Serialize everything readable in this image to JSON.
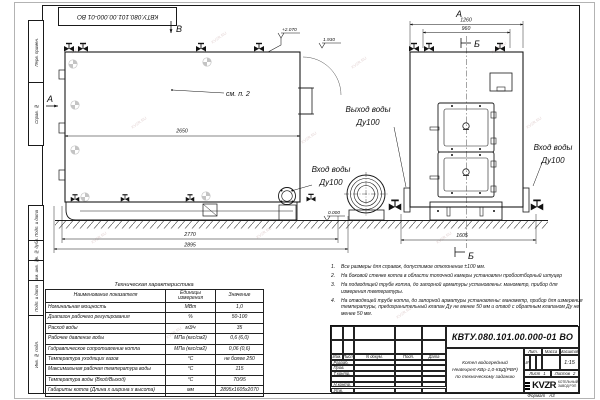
{
  "watermark": "KVZR.RU",
  "top_stamp": "КВТУ.080.101.00.000-01  ВО",
  "margin_labels": [
    "Перв. примен.",
    "Справ. №",
    "Подп. и дата",
    "Инв. № дубл.",
    "Взам. инв. №",
    "Подп. и дата",
    "Инв. № подл."
  ],
  "views": {
    "side": {
      "view_arrow_top": "В",
      "view_arrow_left": "А",
      "callout": "см. п. 2",
      "dim_length": "2650",
      "dim_base": "2770",
      "dim_overall": "2895",
      "elev_top": "+2.070",
      "elev_mid": "1.930",
      "elev_zero": "0.000"
    },
    "front": {
      "view_label": "А",
      "section_label": "Б",
      "dim_width": "1260",
      "dim_inner": "960",
      "dim_overall": "1605"
    },
    "pipes": {
      "outlet_title": "Выход воды",
      "outlet_dn": "Ду100",
      "inlet_title": "Вход воды",
      "inlet_dn": "Ду100"
    }
  },
  "table": {
    "title": "Техническая характеристика",
    "headers": [
      "Наименование показателя",
      "Единицы измерения",
      "Значение"
    ],
    "rows": [
      [
        "Номинальная мощность",
        "МВт",
        "1,0"
      ],
      [
        "Диапазон рабочего регулирования",
        "%",
        "50-100"
      ],
      [
        "Расход воды",
        "м3/ч",
        "35"
      ],
      [
        "Рабочее давление воды",
        "МПа (кгс/см2)",
        "0,6 (6,0)"
      ],
      [
        "Гидравлическое сопротивление котла",
        "МПа (кгс/см2)",
        "0,06 (0,6)"
      ],
      [
        "Температура уходящих газов",
        "°С",
        "не более 250"
      ],
      [
        "Максимальная рабочая температура воды",
        "°С",
        "115"
      ],
      [
        "Температура воды (Вход/Выход)",
        "°С",
        "70/95"
      ],
      [
        "Габариты котла (Длина х ширина х высота)",
        "мм",
        "2895х1605х2070"
      ]
    ]
  },
  "notes": [
    {
      "n": "1.",
      "text": "Все размеры для справок, допустимое отклонение ±100 мм."
    },
    {
      "n": "2.",
      "text": "На боковой стенке котла в области топочной камеры установлен пробоотборный штуцер"
    },
    {
      "n": "3.",
      "text": "На подводящей трубе котла, до запорной арматуры установлены: манометр, прибор для измерения температуры."
    },
    {
      "n": "4.",
      "text": "На отводящей трубе котла, до запорной арматуры установлены: манометр, прибор для измерения температуры, предохранительный клапан Ду не менее 50 мм и отвод с обратным клапаном Ду не менее 50 мм."
    }
  ],
  "titleblock": {
    "doc_number": "КВТУ.080.101.00.000-01  ВО",
    "product_line1": "Котел водогрейный",
    "product_line2": "Heatexpert-КВр-1,0-КБД(РВР)",
    "product_line3": "по техническому заданию",
    "col_izm": "Изм.",
    "col_list": "Лист",
    "col_ndoc": "N докум.",
    "col_podp": "Подп.",
    "col_data": "Дата",
    "row_razrab": "Разраб.",
    "row_prov": "Пров.",
    "row_tkontr": "Т.контр.",
    "row_nkontr": "Н.контр.",
    "row_utv": "Утв.",
    "lit_header": "Лит.",
    "mass_header": "Масса",
    "scale_header": "Масштаб",
    "lit_value": "И",
    "scale_value": "1:15",
    "sheet_label": "Лист",
    "sheet_value": "1",
    "sheets_label": "Листов",
    "sheets_value": "2",
    "logo_text": "KVZR",
    "logo_sub1": "КОТЕЛЬНЫЙ",
    "logo_sub2": "ЗАВОД РЭП",
    "format_label": "Формат",
    "format_value": "А3"
  }
}
